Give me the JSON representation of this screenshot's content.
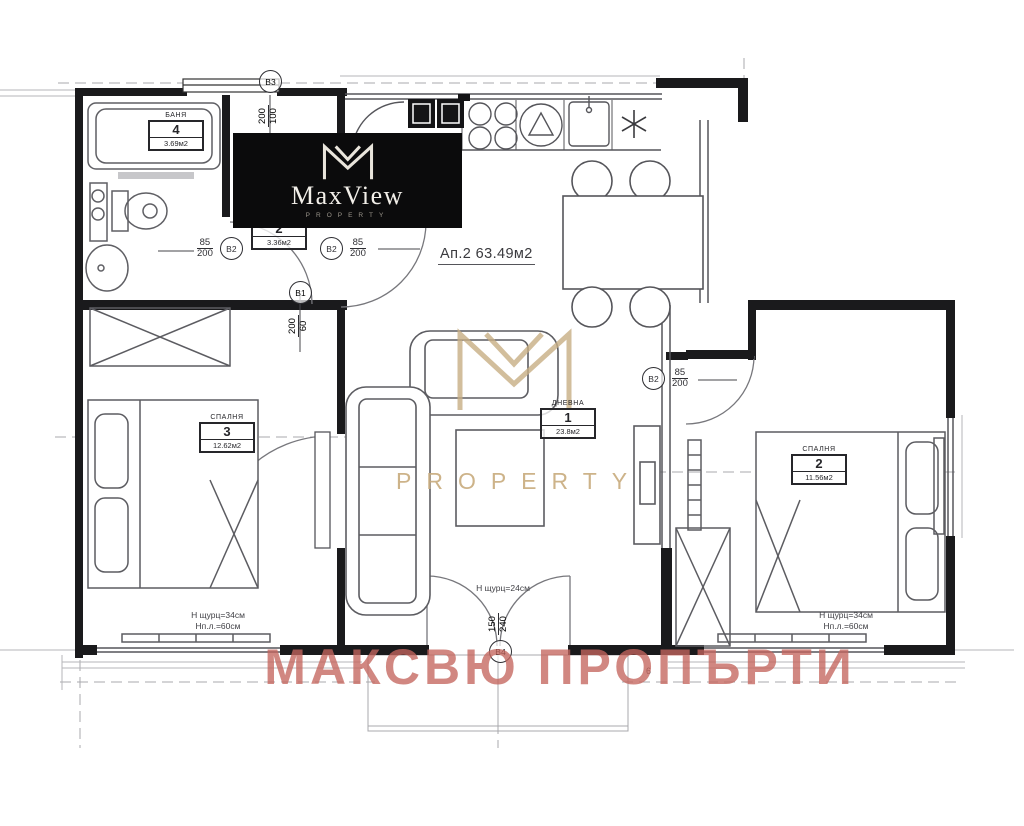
{
  "title": {
    "apartment": "Ап.2 63.49м2"
  },
  "logo": {
    "brand": "MaxView",
    "sub": "PROPERTY"
  },
  "watermarks": {
    "property": "PROPERTY",
    "bottom": "МАКСВЮ ПРОПЪРТИ",
    "gold_color": "#c8ae84",
    "red_color": "#c4655e"
  },
  "rooms": {
    "bath": {
      "name": "БАНЯ",
      "number": "4",
      "area": "3.69м2"
    },
    "hall": {
      "number": "2",
      "area": "3.36м2"
    },
    "living": {
      "name": "ДНЕВНА",
      "number": "1",
      "area": "23.8м2"
    },
    "bedroom3": {
      "name": "СПАЛНЯ",
      "number": "3",
      "area": "12.62м2"
    },
    "bedroom2": {
      "name": "СПАЛНЯ",
      "number": "2",
      "area": "11.56м2"
    }
  },
  "openings": {
    "door_hall_bath": {
      "mark": "В2",
      "w": "85",
      "h": "200"
    },
    "door_hall_living": {
      "mark": "В2",
      "w": "85",
      "h": "200"
    },
    "door_bedroom2": {
      "mark": "В2",
      "w": "85",
      "h": "200"
    },
    "opening_kitchen": {
      "mark": "В1",
      "w": "200",
      "h": "60"
    },
    "window_top": {
      "mark": "В3",
      "w": "200",
      "h": "100"
    },
    "door_terrace": {
      "mark": "В4",
      "w": "150",
      "h": "240"
    }
  },
  "notes": {
    "left": [
      "Н щурц=34см",
      "Нп.л.=60см"
    ],
    "center": "Н щурц=24см",
    "right": [
      "Н щурц=34см",
      "Нп.л.=60см"
    ]
  },
  "axis": {
    "n6": "6"
  }
}
